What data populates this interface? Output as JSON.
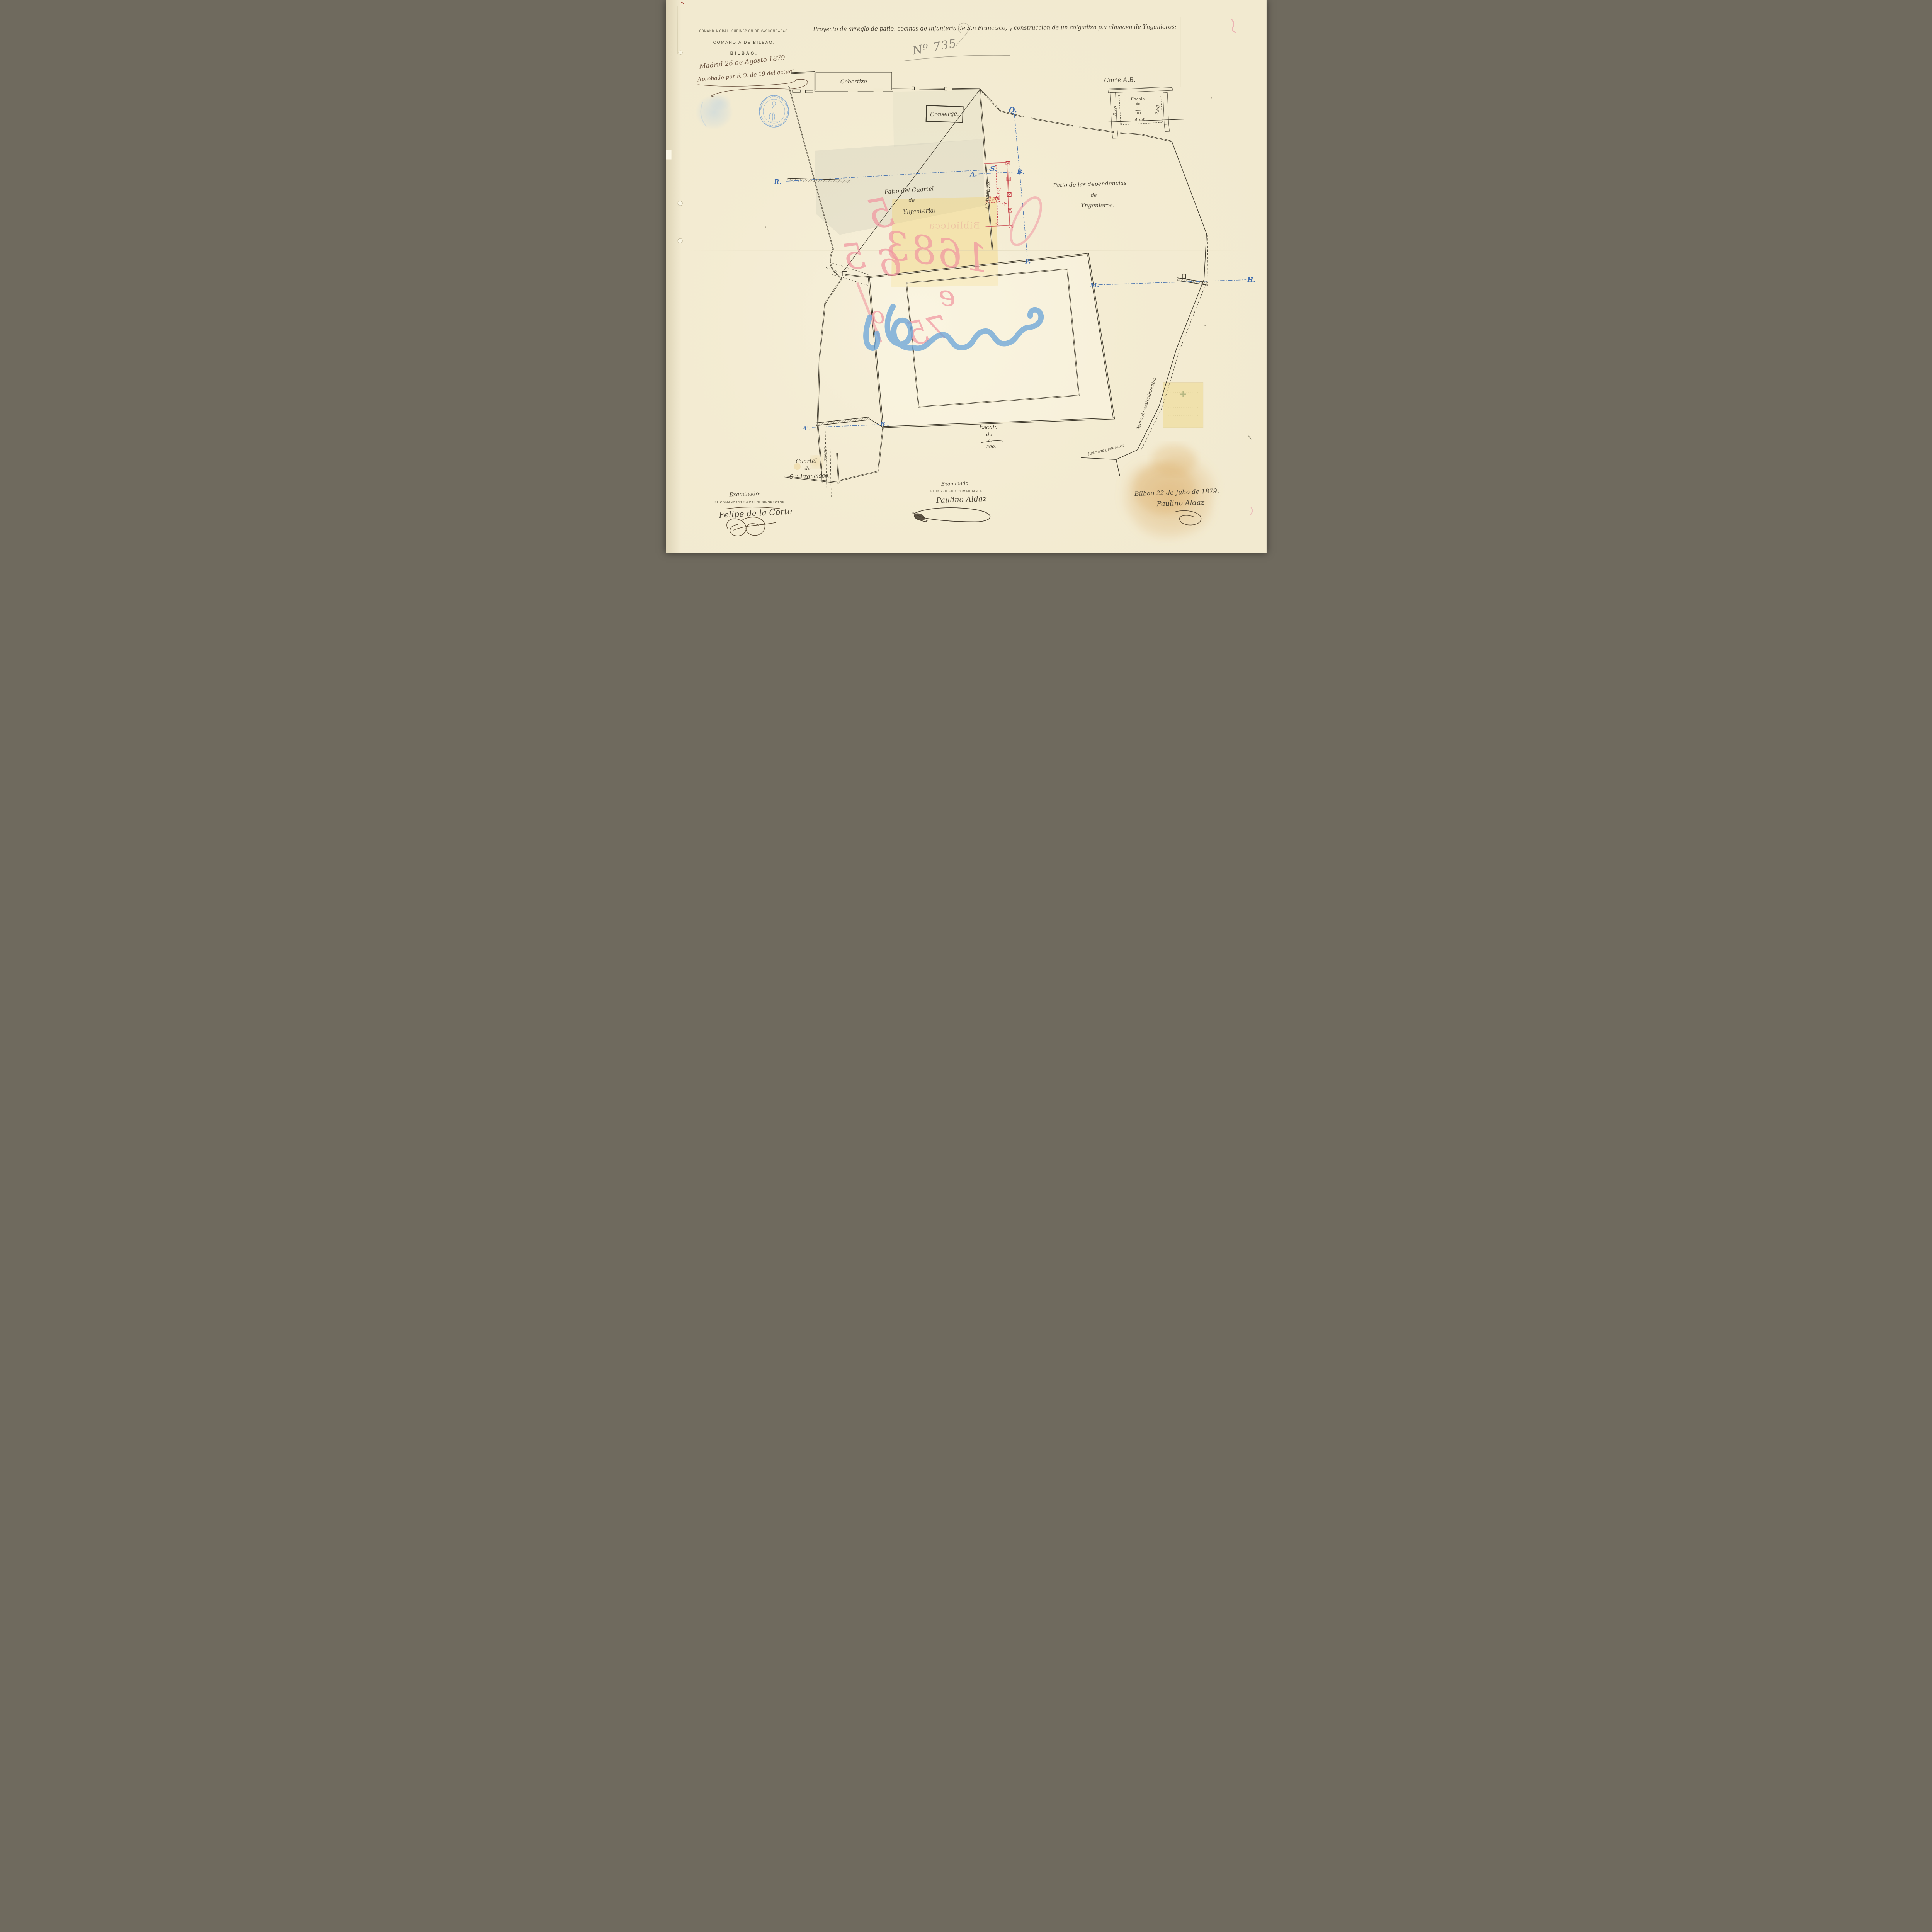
{
  "document": {
    "office": {
      "line1": "COMAND.A GRAL. SUBINSP.ON DE VASCONGADAS.",
      "line2": "COMAND.A DE BILBAO.",
      "line3": "BILBAO."
    },
    "title": "Proyecto de arreglo de patio, cocinas de infanteria de S.n Francisco, y construccion de un colgadizo p.a almacen de Yngenieros:",
    "approval": {
      "line1": "Madrid 26 de Agosto 1879",
      "line2": "Aprobado por R.O. de 19 del actual"
    },
    "file_number": "Nº 735",
    "stamp": {
      "text": "DEPOSITO GENERAL TOPOGRAFICO DE INGENIEROS",
      "star": "✶"
    }
  },
  "plan": {
    "labels": {
      "cobertizo_top": "Cobertizo",
      "conserje": "Conserge.",
      "patio_infanteria": {
        "l1": "Patio del Cuartel",
        "l2": "de",
        "l3": "Ynfanteria:"
      },
      "patio_ingenieros": {
        "l1": "Patio de las dependencias",
        "l2": "de",
        "l3": "Yngenieros."
      },
      "colgadizo": "Cobertizo.",
      "cuartel": {
        "l1": "Cuartel",
        "l2": "de",
        "l3": "S.n Francisco."
      },
      "cuneta": "Cuneta",
      "muro": "Muro de sostenimientos",
      "letrinas": "Letrinas generales",
      "escala": {
        "l1": "Escala",
        "l2": "de",
        "num": "1.",
        "den": "200."
      }
    },
    "dimensions": {
      "shed_length": "16.mt",
      "shed_width": "4.mt"
    },
    "section_letters": {
      "r": "R.",
      "s": "S.",
      "a": "A.",
      "b": "B.",
      "q": "Q.",
      "p": "P.",
      "m": "M.",
      "h": "H.",
      "a_prime": "A'.",
      "b_prime": "B'."
    },
    "corte": {
      "title": "Corte A.B.",
      "escala": {
        "l1": "Escala",
        "l2": "de",
        "num": "1",
        "den": "100"
      },
      "dim_left": "3.10",
      "dim_right": "2.60",
      "dim_bottom": "4.mt"
    },
    "colors": {
      "ink": "#3e392c",
      "new_work_red": "#c43a43",
      "section_blue": "#3f6cae",
      "chalk_pink": "#f096a2",
      "crayon_blue": "#6ea7d8",
      "paper": "#f2ead0",
      "wash_pink": "#f1c5c1",
      "wash_tan": "#ecd1a2",
      "post_orange": "#e3a23c",
      "stamp_blue": "#6d9bd0"
    }
  },
  "chalk": {
    "c1": "5",
    "c2": "5",
    "c3": "6",
    "c4": "1683",
    "c5": "75",
    "c6": "e",
    "c7": "o",
    "print": "Biblioteca"
  },
  "signatures": {
    "left": {
      "heading": "Examinado:",
      "role": "EL COMANDANTE GRAL SUBINSPECTOR.",
      "name": "Felipe de la Corte"
    },
    "center": {
      "heading": "Examinado:",
      "role": "EL INGENIERO COMANDANTE",
      "name": "Paulino Aldaz"
    },
    "right": {
      "date": "Bilbao 22 de Julio de 1879.",
      "name": "Paulino Aldaz"
    }
  }
}
